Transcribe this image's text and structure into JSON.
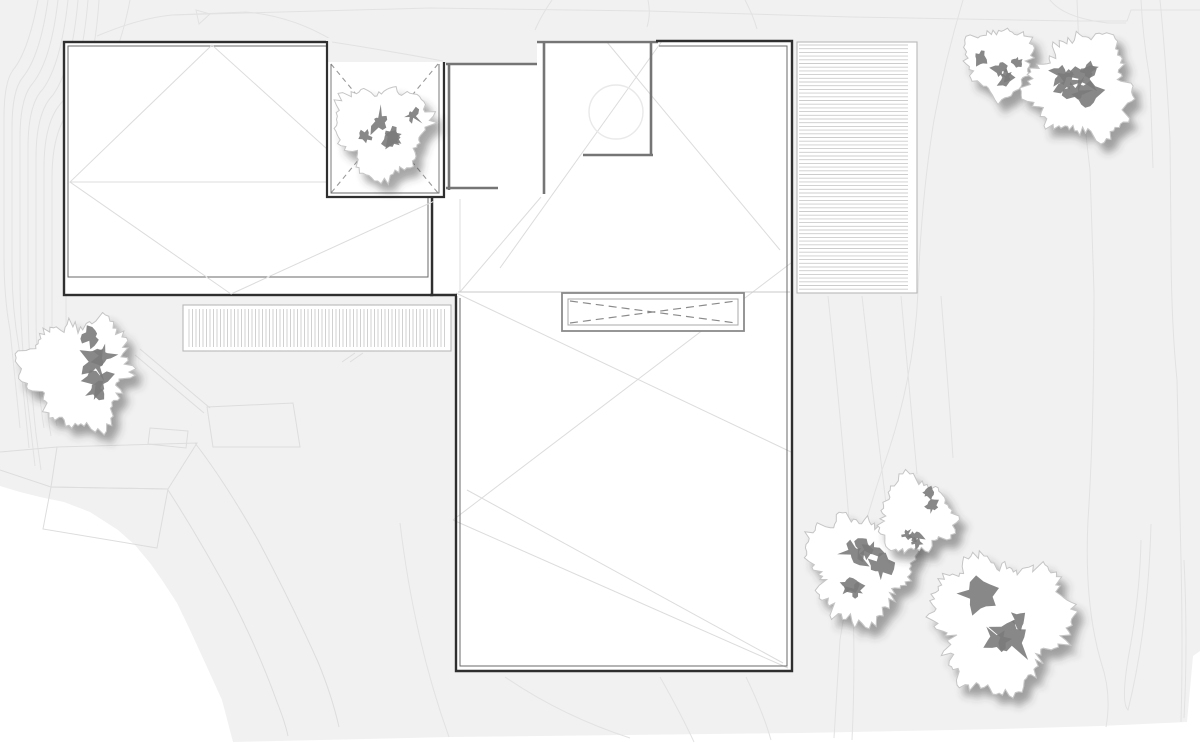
{
  "meta": {
    "title": "architectural-roof-site-plan",
    "canvas": {
      "w": 1200,
      "h": 743
    }
  },
  "palette": {
    "page": "#ffffff",
    "site": "#f1f1f1",
    "contour": "#e2e2e2",
    "garden": "#dddddd",
    "outline": "#2f2f2f",
    "inner": "#6a6a6a",
    "wall": "#757575",
    "faint": "#dcdcdc",
    "light": "#c9c9c9",
    "stripe": "#cccccc",
    "deck_border": "#b8b8b8",
    "dash": "#999999",
    "skylight_edge": "#8a8a8a",
    "skylight_inner": "#a8a8a8",
    "circle": "#e9e9e9",
    "tree_fill": "#ffffff",
    "tree_outline": "#c5c5c5",
    "tree_blob": "#7b7b7b",
    "shadow": "#3c3c3c"
  },
  "site": {
    "outline": "M0,0 L1200,0 L1200,651 L1193,656 L1187,722 L1100,726 L1000,729 L800,733 L450,737 L233,742 L222,700 L207,667 L190,630 L177,603 L162,580 L150,563 L135,545 L118,530 L90,512 L64,502 L40,497 L20,492 L0,486 Z",
    "contours": [
      "M38,0 Q28,52 13,70 Q4,82 4,118 L4,256 Q4,298 10,330 L20,428",
      "M48,0 Q40,56 23,77 Q12,90 12,128 L12,268 Q12,308 19,348 L29,448",
      "M58,0 Q51,60 33,83 Q20,97 20,138 L20,278 Q20,330 27,396 L35,466",
      "M68,0 Q61,64 43,89 Q28,104 28,148 L28,298 Q28,360 36,434 L41,470",
      "M78,0 Q72,68 53,95 Q36,112 36,158 L36,308 Q36,380 44,428",
      "M88,0 Q82,72 63,101 Q44,120 44,168 L44,328 Q44,396 51,436",
      "M99,0 Q94,76 73,107 Q52,128 52,178 L52,338 Q52,400 57,426",
      "M130,0 Q119,58 95,94 Q74,120 71,168 L66,298 Q66,380 70,416",
      "M97,36 Q140,18 172,15 L246,12 Q292,16 332,40 Q392,55 443,61",
      "M172,15 L430,8 L648,11 L852,17 L1074,21 L1127,21 L1131,10 L1200,10",
      "M196,10 L210,14 L199,24 Z",
      "M552,0 Q541,16 535,30",
      "M648,0 Q651,14 647,27",
      "M745,0 Q753,15 757,29",
      "M1050,0 Q1064,18 1108,23 L1126,23",
      "M1141,0 Q1143,40 1150,80 L1153,168",
      "M1160,0 Q1166,60 1170,140 L1171,240 Q1171,320 1177,380 L1181,560 Q1183,650 1181,722",
      "M963,0 Q945,60 934,120 Q921,200 918,292 Q914,382 882,470 Q852,560 840,640 L834,738",
      "M1077,0 Q1080,90 1090,170 L1094,292 Q1094,430 1088,520 Q1084,604 1101,662 Q1112,694 1106,727",
      "M1151,524 Q1148,630 1128,710 Q1120,702 1130,648 Q1140,592 1141,540",
      "M1184,560 Q1188,644 1184,718",
      "M828,296 Q841,420 849,520 Q857,640 852,740",
      "M862,296 Q877,430 888,520",
      "M901,296 Q911,410 917,474",
      "M941,296 Q949,396 953,458",
      "M505,677 Q562,716 630,738",
      "M660,677 Q681,714 694,742",
      "M746,677 Q763,712 771,740",
      "M400,523 Q414,640 449,737"
    ]
  },
  "garden": {
    "beds": [
      "M57,447 L197,443 L168,489 L51,487 Z",
      "M51,487 L168,489 L157,548 L43,529 Z",
      "M207,407 L293,403 L300,447 L213,447 Z",
      "M150,428 L188,431 L186,448 L148,444 Z"
    ],
    "paths": [
      "M0,452 L57,447",
      "M0,470 L51,487",
      "M140,349 L210,408",
      "M135,355 L204,413",
      "M195,443 Q225,482 258,540 Q291,602 318,662 Q332,696 339,727",
      "M168,490 Q201,541 233,601 Q259,652 277,702 Q285,722 288,736",
      "M342,362 L355,353",
      "M350,362 L363,353"
    ]
  },
  "decks": [
    {
      "name": "slatted-deck-west",
      "x": 183,
      "y": 305,
      "w": 268,
      "h": 46,
      "dir": "v",
      "pad": [
        4,
        6,
        4,
        6
      ],
      "gap": 3.5
    },
    {
      "name": "slatted-deck-east",
      "x": 797,
      "y": 42,
      "w": 120,
      "h": 251,
      "dir": "h",
      "pad": [
        3,
        9,
        3,
        2
      ],
      "gap": 3.7
    }
  ],
  "building": {
    "left_wing": {
      "outer": [
        64,
        42,
        368,
        253
      ],
      "inner": [
        68,
        46,
        360,
        231
      ],
      "roof_lines": [
        "M212,45 L70,182 L231,294",
        "M70,182 L326,182",
        "M212,45 L327,149",
        "M231,294 L441,198"
      ]
    },
    "notch_patio": {
      "gray_patch": [
        326,
        38,
        119,
        25
      ],
      "patch_contour": "M332,42 Q390,51 443,61",
      "floor": [
        328,
        62,
        114,
        135
      ],
      "dashed": [
        "M331,64 L438,193",
        "M438,64 L331,193"
      ],
      "outer": "M327,41 L327,197 L444,197 L444,62",
      "inner": "M331,64 L331,193 L439,193 L439,64"
    },
    "courtyard": {
      "floor": "M434,197 L443,197 L443,63 L537,63 L537,40 L656,40 L656,296 L434,296 Z",
      "walls": [
        [
          449,
          63,
          449,
          190
        ],
        [
          446,
          64,
          537,
          64
        ],
        [
          446,
          188,
          498,
          188
        ],
        [
          544,
          41,
          544,
          194
        ],
        [
          537,
          42,
          658,
          42
        ],
        [
          651,
          43,
          651,
          156
        ],
        [
          583,
          155,
          653,
          155
        ]
      ],
      "circle": {
        "cx": 616,
        "cy": 112,
        "r": 27
      }
    },
    "main_wing": {
      "floor_lower": [
        456,
        291,
        336,
        380
      ],
      "floor_upper": [
        656,
        42,
        136,
        250
      ],
      "outer": "M456,296 L456,671 L792,671 L792,41 L656,41",
      "inner": "M460,298 L460,666 L787,666 L787,46 L659,46",
      "connector": "M430,295 L457,295",
      "eave_line": "M458,292 L790,292",
      "faint_lines": [
        "M662,41 L500,268",
        "M606,41 L780,250",
        "M460,199 L460,292",
        "M460,292 L541,197",
        "M456,293 L791,452",
        "M453,520 L791,263",
        "M453,520 L788,668",
        "M467,490 L783,663"
      ]
    },
    "skylight": {
      "outer": [
        562,
        293,
        182,
        38
      ],
      "inner": [
        568,
        299,
        170,
        26
      ],
      "dashed": [
        "M570,301 L736,323",
        "M570,323 L736,301"
      ]
    }
  },
  "trees": [
    {
      "name": "tree-west",
      "cx": 78,
      "cy": 372,
      "r": 66,
      "seed": 22
    },
    {
      "name": "tree-courtyard",
      "cx": 382,
      "cy": 130,
      "r": 56,
      "seed": 11
    },
    {
      "name": "tree-northeast-small",
      "cx": 1000,
      "cy": 61,
      "r": 41,
      "seed": 33
    },
    {
      "name": "tree-northeast-large",
      "cx": 1082,
      "cy": 86,
      "r": 62,
      "seed": 44
    },
    {
      "name": "tree-southeast-a",
      "cx": 861,
      "cy": 566,
      "r": 64,
      "seed": 55
    },
    {
      "name": "tree-southeast-b",
      "cx": 915,
      "cy": 516,
      "r": 46,
      "seed": 66
    },
    {
      "name": "tree-southeast-c",
      "cx": 1000,
      "cy": 622,
      "r": 82,
      "seed": 77
    }
  ]
}
